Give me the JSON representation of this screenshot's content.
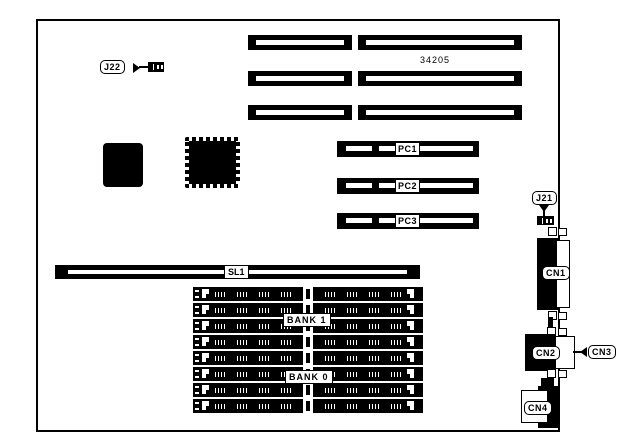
{
  "part_number": "34205",
  "labels": {
    "j22": "J22",
    "j21": "J21",
    "pci": [
      "PC1",
      "PC2",
      "PC3"
    ],
    "sl1": "SL1",
    "bank1": "BANK 1",
    "bank0": "BANK 0",
    "cn1": "CN1",
    "cn2": "CN2",
    "cn3": "CN3",
    "cn4": "CN4"
  },
  "colors": {
    "line": "#000000",
    "background": "#ffffff"
  }
}
